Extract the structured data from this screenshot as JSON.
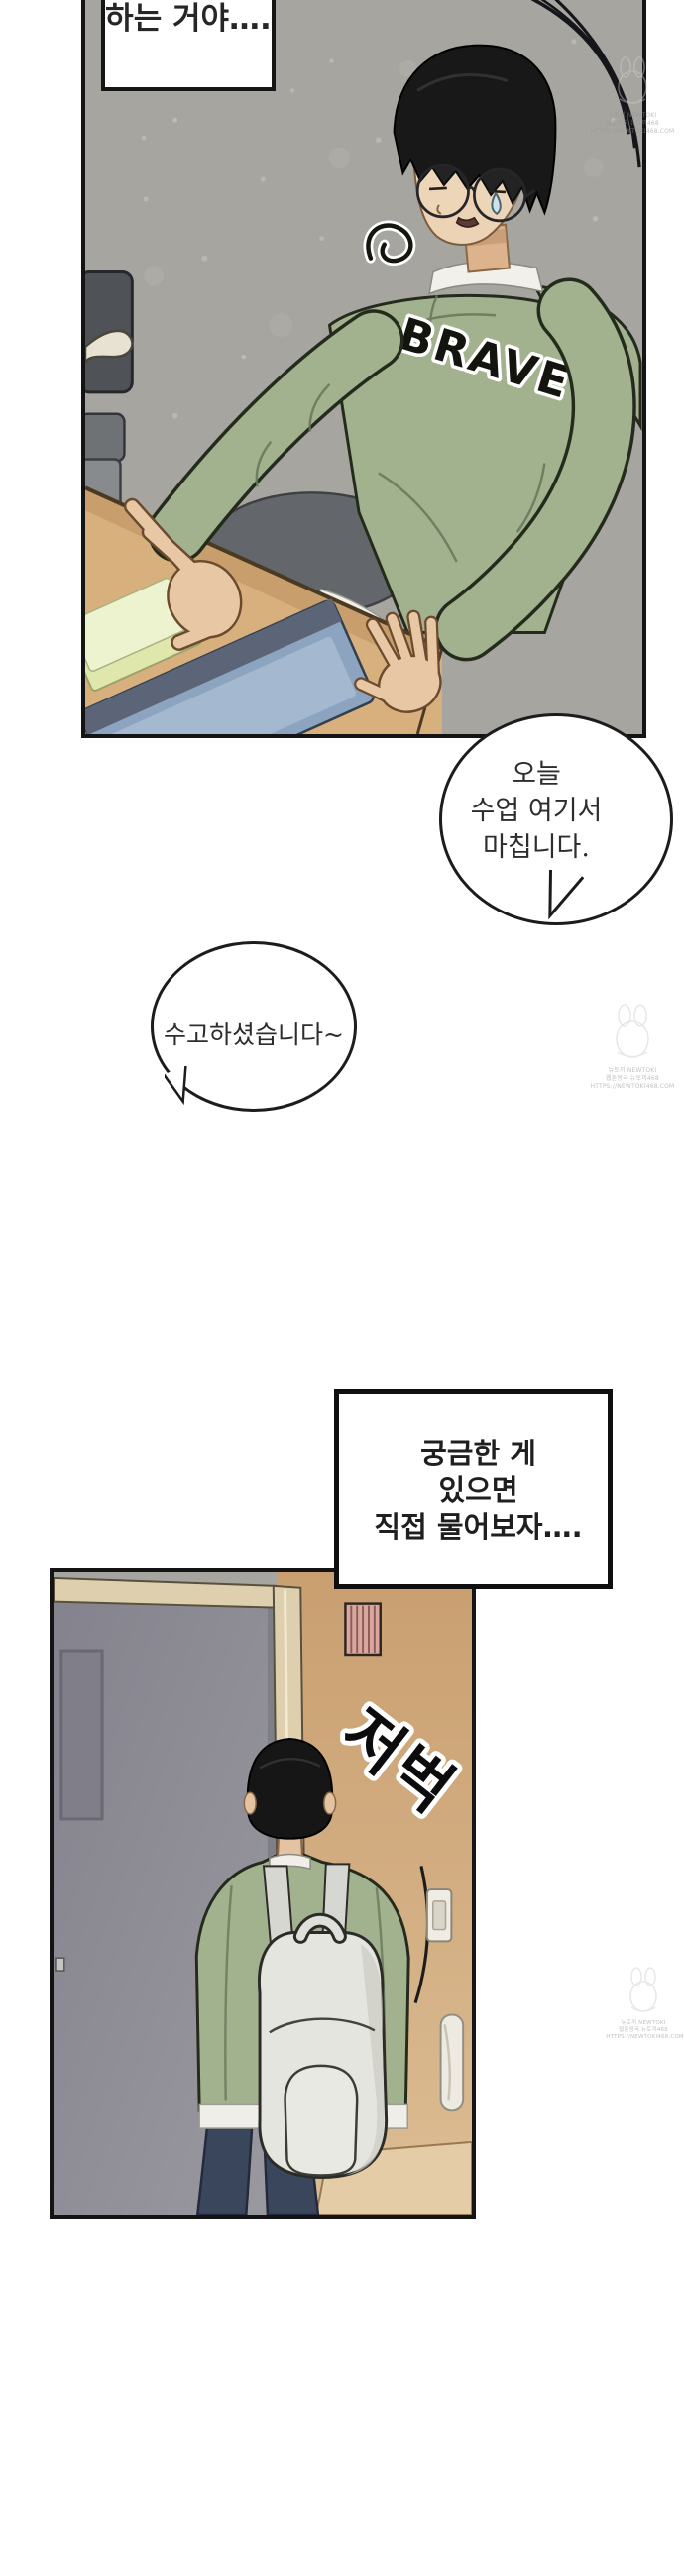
{
  "speech": {
    "cutoff_box": {
      "line1": "하는 거야…."
    },
    "class_end_bubble": {
      "line1": "오늘",
      "line2": "수업 여기서",
      "line3": "마칩니다."
    },
    "thanks_bubble": {
      "line1": "수고하셨습니다~"
    },
    "monologue_box": {
      "line1": "궁금한 게",
      "line2": "있으면",
      "line3": "직접 물어보자…."
    }
  },
  "artwork": {
    "shirt_print": "BRAVE",
    "sfx_footsteps": "저벅"
  },
  "watermark": {
    "line1": "뉴토끼 NEWTOKI",
    "line2": "웹툰왕국 뉴토끼468",
    "line3": "HTTPS://NEWTOKI468.COM"
  },
  "colors": {
    "panel_border": "#141414",
    "wall_gray": "#a6a5a0",
    "sweatshirt_green": "#a3b28e",
    "desk_wood": "#d8b07e",
    "hair_black": "#181818",
    "skin": "#e6c49e",
    "jeans_navy": "#3a465c",
    "door_gray": "#8e8d96",
    "door_frame_cream": "#decfae",
    "wall_tan": "#cfa67a",
    "vent_pink": "#d8a8a0",
    "backpack_white": "#e6e6e1"
  }
}
